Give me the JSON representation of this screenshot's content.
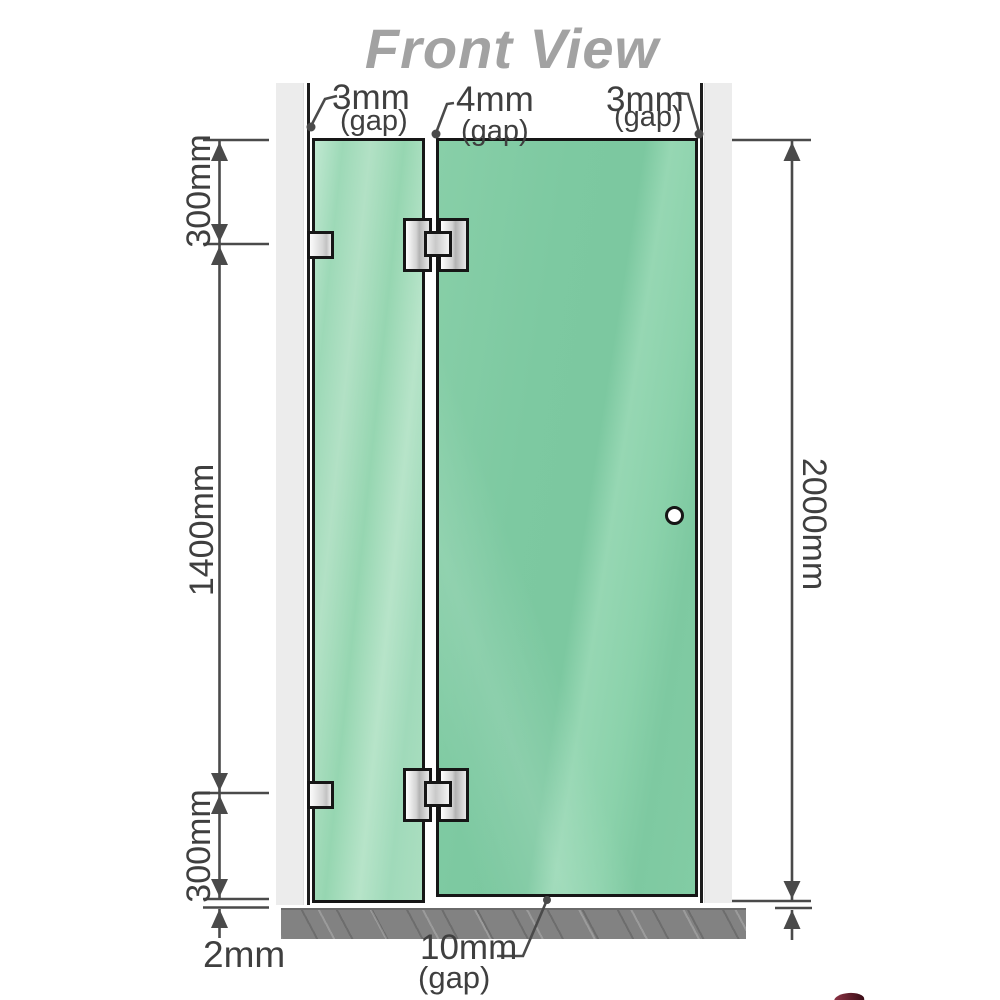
{
  "title": "Front View",
  "top_gaps": {
    "left": {
      "value": "3mm",
      "suffix": "(gap)"
    },
    "middle": {
      "value": "4mm",
      "suffix": "(gap)"
    },
    "right": {
      "value": "3mm",
      "suffix": "(gap)"
    }
  },
  "left_dimensions": {
    "top_segment": "300mm",
    "middle_segment": "1400mm",
    "bottom_segment": "300mm",
    "floor_clearance": "2mm"
  },
  "right_dimensions": {
    "total_height": "2000mm"
  },
  "bottom_gap": {
    "value": "10mm",
    "suffix": "(gap)"
  },
  "colors": {
    "glass_fixed_panel": "#9dd9b7",
    "glass_door": "#7dc9a1",
    "wall_post": "#ececec",
    "floor": "#828282",
    "outline": "#161616",
    "dimension_lines": "#4a4a4a",
    "title_text": "#a2a2a2",
    "fitting_metal": "#d2d2d2"
  }
}
